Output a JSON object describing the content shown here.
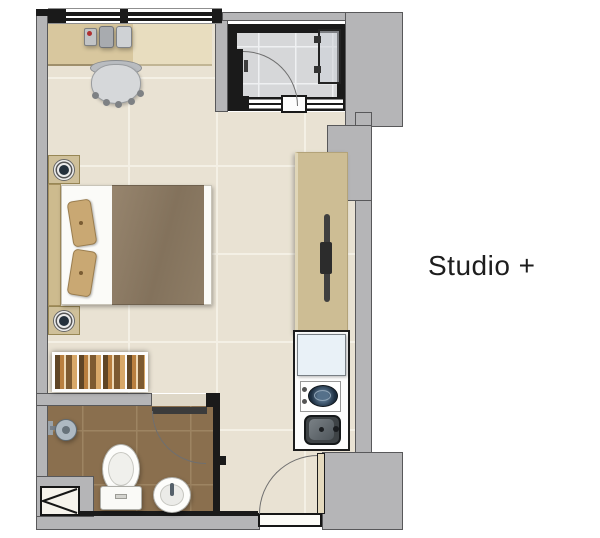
{
  "title": {
    "label": "Studio +"
  },
  "plan": {
    "rooms": [
      "main-room",
      "shower-room",
      "bathroom",
      "kitchenette"
    ],
    "fixtures": [
      "window",
      "desk",
      "desk-organizer",
      "office-chair",
      "double-bed",
      "pillows",
      "nightstand-lamp",
      "wardrobe",
      "kitchen-counter",
      "counter-faucet",
      "refrigerator",
      "cooktop",
      "kitchen-sink",
      "entrance-door",
      "shower-room-door",
      "shower-glass-panel",
      "bathroom-door",
      "toilet",
      "washbasin",
      "shower-head",
      "service-shaft"
    ]
  },
  "palette": {
    "wall_gray": "#b5b5b7",
    "wall_dark": "#1a1a1a",
    "floor_main": "#e9e2d3",
    "floor_bathroom": "#8a6f4e",
    "floor_shower": "#d6d7d9",
    "wood_desk": "#d8c79e",
    "wood_counter": "#cdbd94",
    "bed_blanket": "#8e7c65",
    "text": "#1d1d1d"
  }
}
